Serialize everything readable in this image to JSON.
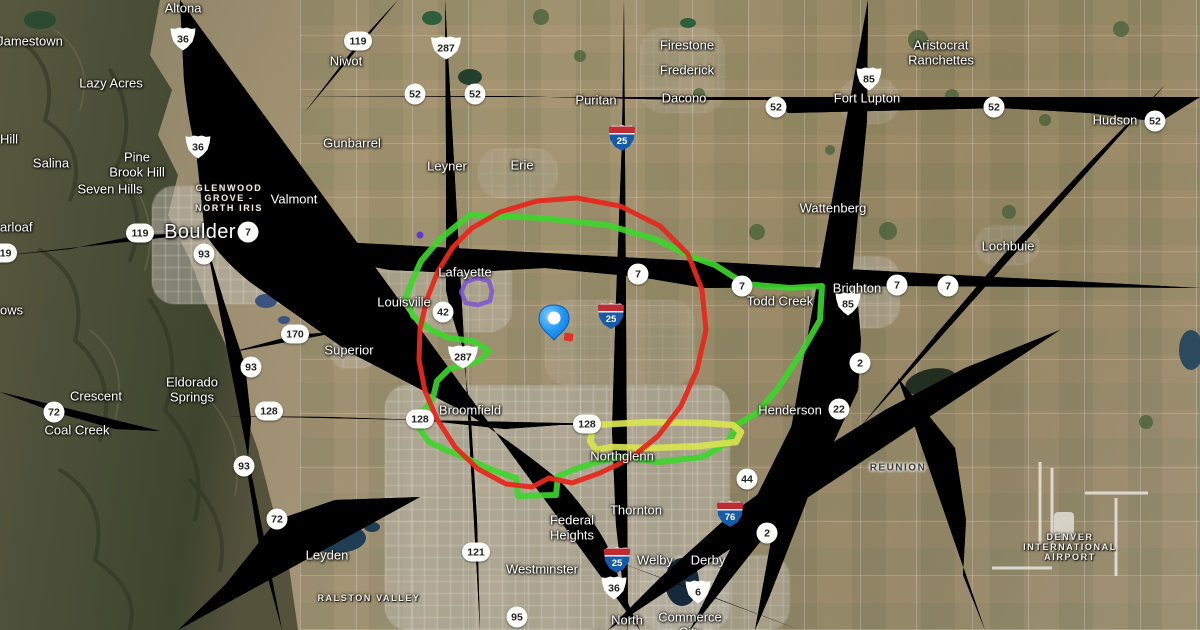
{
  "map": {
    "kind": "satellite-map-with-route-overlays",
    "colors": {
      "overlay_red": "#e5291e",
      "overlay_green": "#3dd62c",
      "overlay_yellow": "#d9e44e",
      "overlay_purple": "#7b50d2",
      "pin_blue": "#2196f3",
      "road_yellow": "#ecdc96"
    },
    "labels": [
      {
        "text": "Jamestown",
        "x": 30,
        "y": 42,
        "cls": "town"
      },
      {
        "text": "Altona",
        "x": 183,
        "y": 9,
        "cls": "town"
      },
      {
        "text": "Lazy Acres",
        "x": 111,
        "y": 84,
        "cls": "town"
      },
      {
        "text": "Niwot",
        "x": 346,
        "y": 62,
        "cls": "town"
      },
      {
        "text": "Puritan",
        "x": 596,
        "y": 101,
        "cls": "town"
      },
      {
        "text": "Firestone",
        "x": 687,
        "y": 46,
        "cls": "town"
      },
      {
        "text": "Frederick",
        "x": 687,
        "y": 71,
        "cls": "town"
      },
      {
        "text": "Dacono",
        "x": 684,
        "y": 99,
        "cls": "town"
      },
      {
        "text": "Fort Lupton",
        "x": 867,
        "y": 99,
        "cls": "town"
      },
      {
        "text": "Hudson",
        "x": 1115,
        "y": 121,
        "cls": "town"
      },
      {
        "text": "Aristocrat\nRanchettes",
        "x": 941,
        "y": 53,
        "cls": "town"
      },
      {
        "text": "Hill",
        "x": 0,
        "y": 140,
        "cls": "town left"
      },
      {
        "text": "Salina",
        "x": 51,
        "y": 164,
        "cls": "town"
      },
      {
        "text": "Pine\nBrook Hill",
        "x": 137,
        "y": 165,
        "cls": "town"
      },
      {
        "text": "Seven Hills",
        "x": 110,
        "y": 190,
        "cls": "town"
      },
      {
        "text": "GLENWOOD\nGROVE -\nNORTH IRIS",
        "x": 229,
        "y": 198,
        "cls": "hood"
      },
      {
        "text": "Valmont",
        "x": 294,
        "y": 200,
        "cls": "town"
      },
      {
        "text": "Boulder",
        "x": 200,
        "y": 232,
        "cls": "city"
      },
      {
        "text": "arloaf",
        "x": 0,
        "y": 228,
        "cls": "town left"
      },
      {
        "text": "ows",
        "x": 0,
        "y": 311,
        "cls": "town left"
      },
      {
        "text": "Gunbarrel",
        "x": 352,
        "y": 144,
        "cls": "town"
      },
      {
        "text": "Leyner",
        "x": 447,
        "y": 167,
        "cls": "town"
      },
      {
        "text": "Erie",
        "x": 522,
        "y": 166,
        "cls": "town"
      },
      {
        "text": "Wattenberg",
        "x": 833,
        "y": 209,
        "cls": "town"
      },
      {
        "text": "Lochbuie",
        "x": 1008,
        "y": 247,
        "cls": "town"
      },
      {
        "text": "Lafayette",
        "x": 465,
        "y": 273,
        "cls": "town"
      },
      {
        "text": "Louisville",
        "x": 404,
        "y": 303,
        "cls": "town"
      },
      {
        "text": "Brighton",
        "x": 857,
        "y": 289,
        "cls": "town"
      },
      {
        "text": "Todd Creek",
        "x": 780,
        "y": 302,
        "cls": "town"
      },
      {
        "text": "Superior",
        "x": 349,
        "y": 351,
        "cls": "town"
      },
      {
        "text": "Eldorado\nSprings",
        "x": 192,
        "y": 390,
        "cls": "town"
      },
      {
        "text": "Crescent",
        "x": 96,
        "y": 397,
        "cls": "town"
      },
      {
        "text": "Coal Creek",
        "x": 77,
        "y": 431,
        "cls": "town"
      },
      {
        "text": "Broomfield",
        "x": 470,
        "y": 411,
        "cls": "town"
      },
      {
        "text": "Henderson",
        "x": 790,
        "y": 411,
        "cls": "town"
      },
      {
        "text": "REUNION",
        "x": 898,
        "y": 468,
        "cls": "hood-dark"
      },
      {
        "text": "Northglenn",
        "x": 622,
        "y": 457,
        "cls": "town"
      },
      {
        "text": "Thornton",
        "x": 636,
        "y": 511,
        "cls": "town"
      },
      {
        "text": "Federal\nHeights",
        "x": 572,
        "y": 528,
        "cls": "town"
      },
      {
        "text": "Westminster",
        "x": 542,
        "y": 570,
        "cls": "town"
      },
      {
        "text": "Welby",
        "x": 655,
        "y": 561,
        "cls": "town"
      },
      {
        "text": "Derby",
        "x": 708,
        "y": 561,
        "cls": "town"
      },
      {
        "text": "Leyden",
        "x": 327,
        "y": 556,
        "cls": "town"
      },
      {
        "text": "RALSTON VALLEY",
        "x": 369,
        "y": 598,
        "cls": "hood"
      },
      {
        "text": "North\nWashington",
        "x": 627,
        "y": 628,
        "cls": "town"
      },
      {
        "text": "Commerce\nCity",
        "x": 690,
        "y": 625,
        "cls": "town"
      },
      {
        "text": "DENVER\nINTERNATIONAL\nAIRPORT",
        "x": 1070,
        "y": 547,
        "cls": "hood"
      }
    ],
    "shields": [
      {
        "num": "36",
        "type": "us",
        "x": 183,
        "y": 39
      },
      {
        "num": "36",
        "type": "us",
        "x": 198,
        "y": 147
      },
      {
        "num": "36",
        "type": "us",
        "x": 614,
        "y": 588
      },
      {
        "num": "287",
        "type": "us wide",
        "x": 446,
        "y": 48
      },
      {
        "num": "287",
        "type": "us wide",
        "x": 463,
        "y": 357
      },
      {
        "num": "85",
        "type": "us",
        "x": 869,
        "y": 79
      },
      {
        "num": "85",
        "type": "us",
        "x": 848,
        "y": 304
      },
      {
        "num": "6",
        "type": "us",
        "x": 698,
        "y": 592
      },
      {
        "num": "25",
        "type": "i",
        "x": 622,
        "y": 138
      },
      {
        "num": "25",
        "type": "i",
        "x": 611,
        "y": 316
      },
      {
        "num": "25",
        "type": "i",
        "x": 617,
        "y": 560
      },
      {
        "num": "76",
        "type": "i",
        "x": 730,
        "y": 514
      },
      {
        "num": "119",
        "type": "c wide",
        "x": 358,
        "y": 41
      },
      {
        "num": "119",
        "type": "c wide",
        "x": 140,
        "y": 233
      },
      {
        "num": "119",
        "type": "c wide",
        "x": 3,
        "y": 253
      },
      {
        "num": "52",
        "type": "c",
        "x": 415,
        "y": 94
      },
      {
        "num": "52",
        "type": "c",
        "x": 475,
        "y": 94
      },
      {
        "num": "52",
        "type": "c",
        "x": 776,
        "y": 107
      },
      {
        "num": "52",
        "type": "c",
        "x": 994,
        "y": 107
      },
      {
        "num": "52",
        "type": "c",
        "x": 1155,
        "y": 121
      },
      {
        "num": "93",
        "type": "c",
        "x": 204,
        "y": 254
      },
      {
        "num": "93",
        "type": "c",
        "x": 251,
        "y": 367
      },
      {
        "num": "93",
        "type": "c",
        "x": 244,
        "y": 466
      },
      {
        "num": "7",
        "type": "c",
        "x": 248,
        "y": 232
      },
      {
        "num": "7",
        "type": "c",
        "x": 638,
        "y": 274
      },
      {
        "num": "7",
        "type": "c",
        "x": 742,
        "y": 286
      },
      {
        "num": "7",
        "type": "c",
        "x": 897,
        "y": 285
      },
      {
        "num": "7",
        "type": "c",
        "x": 948,
        "y": 286
      },
      {
        "num": "170",
        "type": "c wide",
        "x": 295,
        "y": 334
      },
      {
        "num": "128",
        "type": "c wide",
        "x": 269,
        "y": 411
      },
      {
        "num": "128",
        "type": "c wide",
        "x": 420,
        "y": 419
      },
      {
        "num": "128",
        "type": "c wide",
        "x": 587,
        "y": 424
      },
      {
        "num": "72",
        "type": "c",
        "x": 54,
        "y": 412
      },
      {
        "num": "72",
        "type": "c",
        "x": 277,
        "y": 519
      },
      {
        "num": "42",
        "type": "c",
        "x": 443,
        "y": 312
      },
      {
        "num": "121",
        "type": "c wide",
        "x": 476,
        "y": 552
      },
      {
        "num": "95",
        "type": "c",
        "x": 517,
        "y": 617
      },
      {
        "num": "2",
        "type": "c",
        "x": 860,
        "y": 363
      },
      {
        "num": "2",
        "type": "c",
        "x": 767,
        "y": 533
      },
      {
        "num": "22",
        "type": "c",
        "x": 839,
        "y": 409
      },
      {
        "num": "44",
        "type": "c",
        "x": 747,
        "y": 479
      }
    ],
    "overlays": {
      "green_track": [
        [
          470,
          215
        ],
        [
          540,
          218
        ],
        [
          607,
          225
        ],
        [
          655,
          239
        ],
        [
          690,
          256
        ],
        [
          715,
          265
        ],
        [
          745,
          284
        ],
        [
          790,
          288
        ],
        [
          822,
          286
        ],
        [
          820,
          320
        ],
        [
          800,
          355
        ],
        [
          778,
          388
        ],
        [
          757,
          413
        ],
        [
          738,
          424
        ],
        [
          727,
          443
        ],
        [
          703,
          457
        ],
        [
          658,
          462
        ],
        [
          622,
          457
        ],
        [
          601,
          461
        ],
        [
          581,
          467
        ],
        [
          558,
          476
        ],
        [
          556,
          495
        ],
        [
          518,
          496
        ],
        [
          516,
          478
        ],
        [
          492,
          470
        ],
        [
          466,
          458
        ],
        [
          446,
          450
        ],
        [
          429,
          442
        ],
        [
          419,
          428
        ],
        [
          423,
          412
        ],
        [
          433,
          398
        ],
        [
          437,
          381
        ],
        [
          449,
          369
        ],
        [
          479,
          361
        ],
        [
          489,
          351
        ],
        [
          473,
          341
        ],
        [
          449,
          338
        ],
        [
          431,
          330
        ],
        [
          413,
          316
        ],
        [
          406,
          297
        ],
        [
          413,
          279
        ],
        [
          421,
          261
        ],
        [
          439,
          240
        ],
        [
          456,
          226
        ]
      ],
      "red_circle": [
        [
          577,
          198
        ],
        [
          620,
          206
        ],
        [
          660,
          226
        ],
        [
          688,
          254
        ],
        [
          702,
          290
        ],
        [
          706,
          330
        ],
        [
          697,
          370
        ],
        [
          681,
          406
        ],
        [
          658,
          436
        ],
        [
          631,
          458
        ],
        [
          600,
          473
        ],
        [
          572,
          483
        ],
        [
          549,
          478
        ],
        [
          532,
          487
        ],
        [
          506,
          484
        ],
        [
          478,
          469
        ],
        [
          455,
          447
        ],
        [
          437,
          419
        ],
        [
          425,
          391
        ],
        [
          419,
          360
        ],
        [
          420,
          329
        ],
        [
          427,
          299
        ],
        [
          438,
          271
        ],
        [
          453,
          247
        ],
        [
          472,
          228
        ],
        [
          500,
          212
        ],
        [
          537,
          201
        ]
      ],
      "yellow_loop": [
        [
          594,
          425
        ],
        [
          650,
          422
        ],
        [
          705,
          423
        ],
        [
          733,
          425
        ],
        [
          741,
          432
        ],
        [
          736,
          442
        ],
        [
          700,
          446
        ],
        [
          652,
          448
        ],
        [
          611,
          447
        ],
        [
          596,
          450
        ],
        [
          590,
          441
        ]
      ],
      "purple_ring": [
        [
          466,
          282
        ],
        [
          477,
          278
        ],
        [
          489,
          281
        ],
        [
          492,
          291
        ],
        [
          490,
          301
        ],
        [
          478,
          305
        ],
        [
          466,
          303
        ],
        [
          461,
          292
        ]
      ],
      "purple_dot": [
        420,
        235
      ],
      "pin": [
        554,
        340
      ],
      "red_marker": [
        568,
        338
      ]
    }
  }
}
